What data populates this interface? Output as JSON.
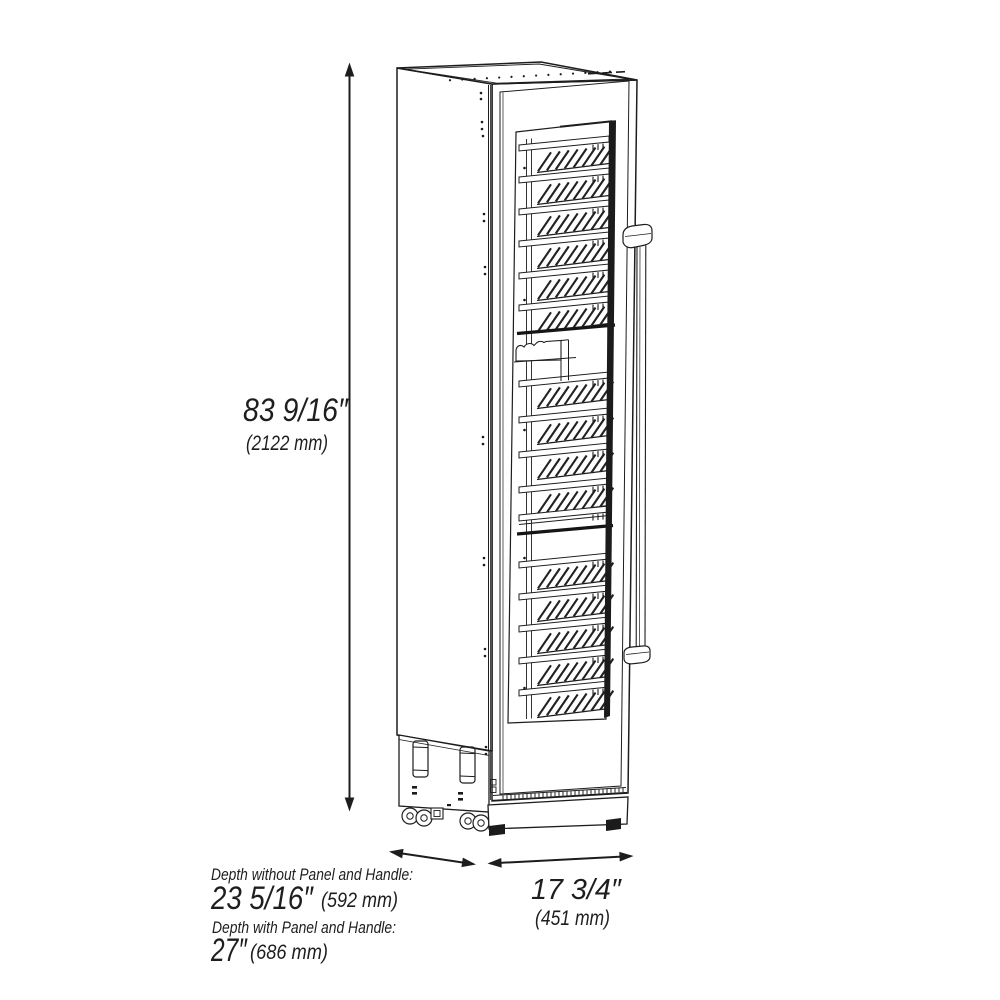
{
  "dimensions": {
    "height": {
      "inches": "83 9/16″",
      "mm": "(2122 mm)"
    },
    "depth_without_panel": {
      "label": "Depth without Panel and Handle:",
      "inches": "23 5/16″",
      "mm": "(592 mm)"
    },
    "depth_with_panel": {
      "label": "Depth with Panel and Handle:",
      "inches": "27″",
      "mm": "(686 mm)"
    },
    "width": {
      "inches": "17 3/4″",
      "mm": "(451 mm)"
    }
  },
  "colors": {
    "line": "#1d1d1d",
    "background": "#ffffff",
    "text": "#1e1e1e"
  }
}
